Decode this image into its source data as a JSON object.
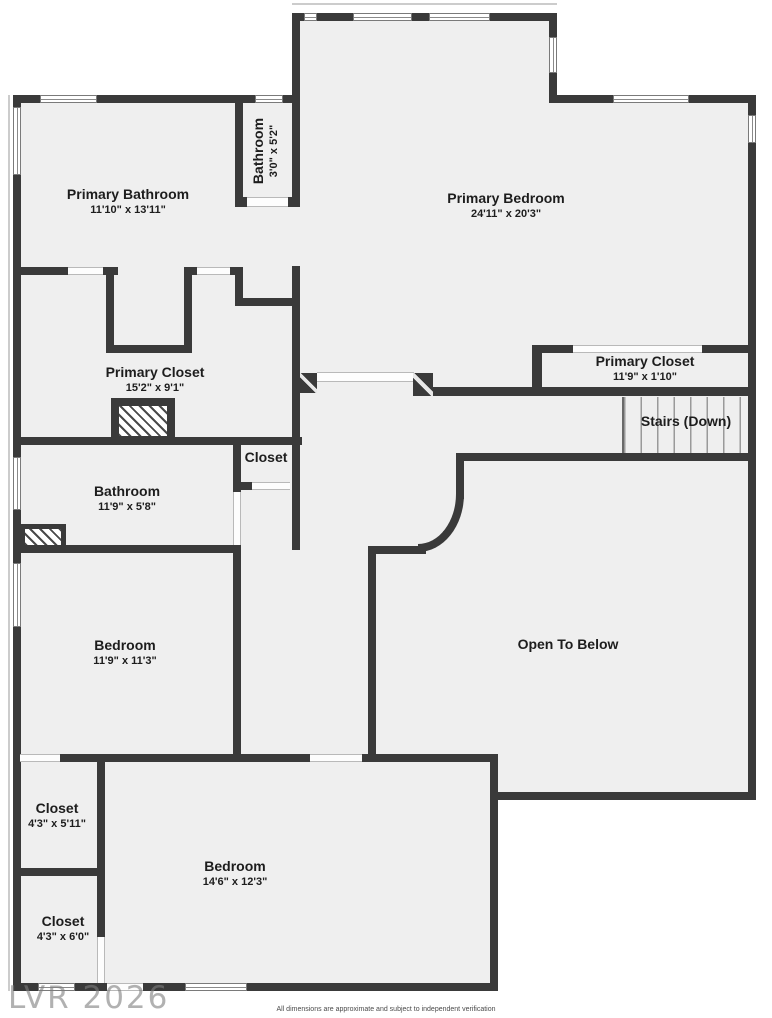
{
  "colors": {
    "wall": "#3a3a3a",
    "floor": "#efefef",
    "background": "#ffffff",
    "label": "#1d1d1d",
    "watermark": "#7d7d7d"
  },
  "rooms": [
    {
      "id": "primary-bathroom",
      "name": "Primary Bathroom",
      "dims": "11'10\" x 13'11\""
    },
    {
      "id": "bathroom-small",
      "name": "Bathroom",
      "dims": "3'0\" x 5'2\""
    },
    {
      "id": "primary-bedroom",
      "name": "Primary Bedroom",
      "dims": "24'11\" x 20'3\""
    },
    {
      "id": "primary-closet-left",
      "name": "Primary Closet",
      "dims": "15'2\" x 9'1\""
    },
    {
      "id": "primary-closet-right",
      "name": "Primary Closet",
      "dims": "11'9\" x 1'10\""
    },
    {
      "id": "stairs-down",
      "name": "Stairs (Down)",
      "dims": ""
    },
    {
      "id": "closet-hall",
      "name": "Closet",
      "dims": ""
    },
    {
      "id": "bathroom",
      "name": "Bathroom",
      "dims": "11'9\" x 5'8\""
    },
    {
      "id": "bedroom-left",
      "name": "Bedroom",
      "dims": "11'9\" x 11'3\""
    },
    {
      "id": "open-to-below",
      "name": "Open To Below",
      "dims": ""
    },
    {
      "id": "closet-upper",
      "name": "Closet",
      "dims": "4'3\" x 5'11\""
    },
    {
      "id": "closet-lower",
      "name": "Closet",
      "dims": "4'3\" x 6'0\""
    },
    {
      "id": "bedroom-bottom",
      "name": "Bedroom",
      "dims": "14'6\" x 12'3\""
    }
  ],
  "watermark": "LVR 2026",
  "footer": "All dimensions are approximate and subject to independent verification"
}
